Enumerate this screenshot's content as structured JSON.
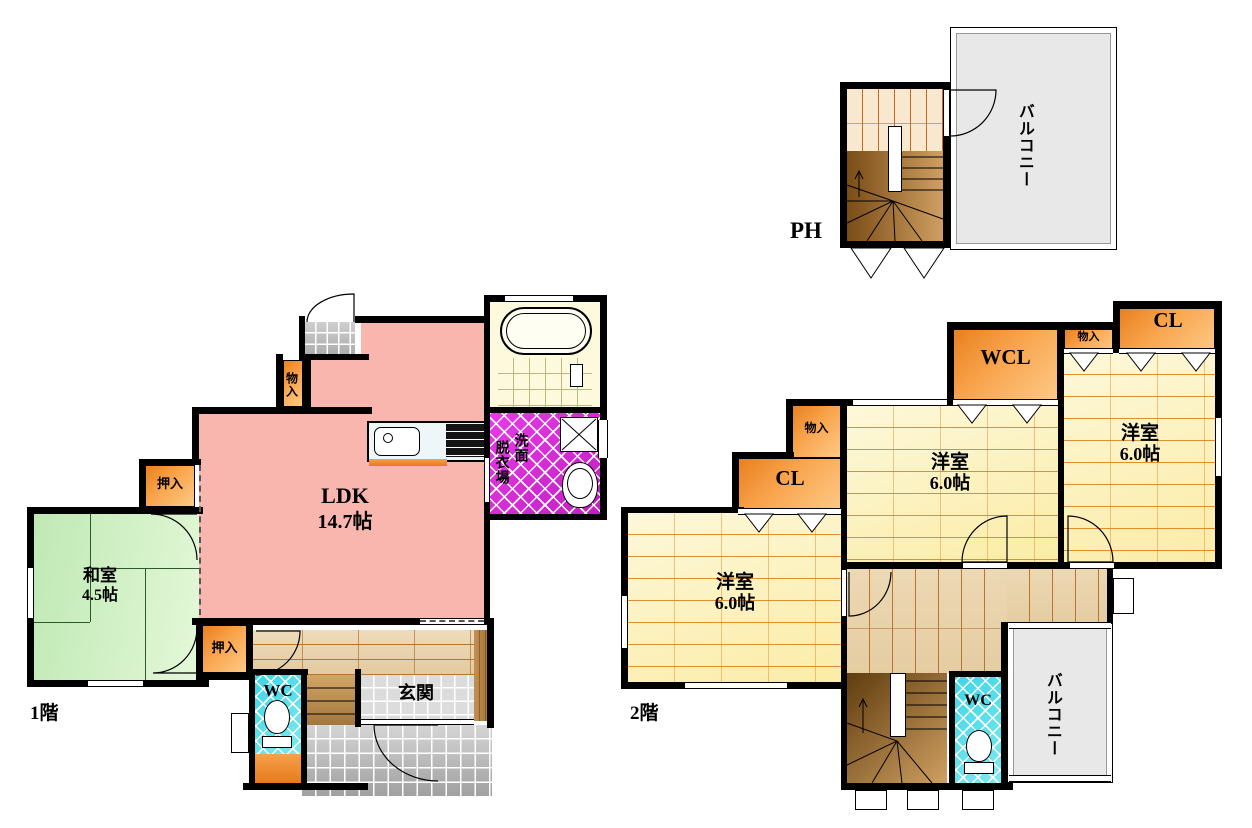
{
  "colors": {
    "ldk_pink": "#f8b6ae",
    "tatami_green": "#cfeec5",
    "closet_orange": "#ef8f31",
    "senmen_magenta": "#d92ed9",
    "wc_cyan": "#4fdbe8",
    "balcony_gray": "#e8e8e8",
    "room_cream": "#fdf4c6",
    "wood_tan": "#ead6b2",
    "stairs_brown": "#8a5a28"
  },
  "floor1": {
    "label": "1階",
    "ldk": {
      "name": "LDK",
      "size": "14.7帖"
    },
    "washitsu": {
      "name": "和室",
      "size": "4.5帖"
    },
    "oshiire_upper": "押入",
    "oshiire_lower": "押入",
    "monoire": "物入",
    "datsuijo": "脱衣場",
    "senmen": "洗面",
    "wc": "WC",
    "genkan": "玄関"
  },
  "floor2": {
    "label": "2階",
    "room_left": {
      "name": "洋室",
      "size": "6.0帖"
    },
    "room_mid": {
      "name": "洋室",
      "size": "6.0帖"
    },
    "room_right": {
      "name": "洋室",
      "size": "6.0帖"
    },
    "cl_left": "CL",
    "cl_right": "CL",
    "wcl": "WCL",
    "monoire_mid": "物入",
    "monoire_right": "物入",
    "wc": "WC",
    "balcony": "バルコニー"
  },
  "ph": {
    "label": "PH",
    "balcony": "バルコニー"
  }
}
